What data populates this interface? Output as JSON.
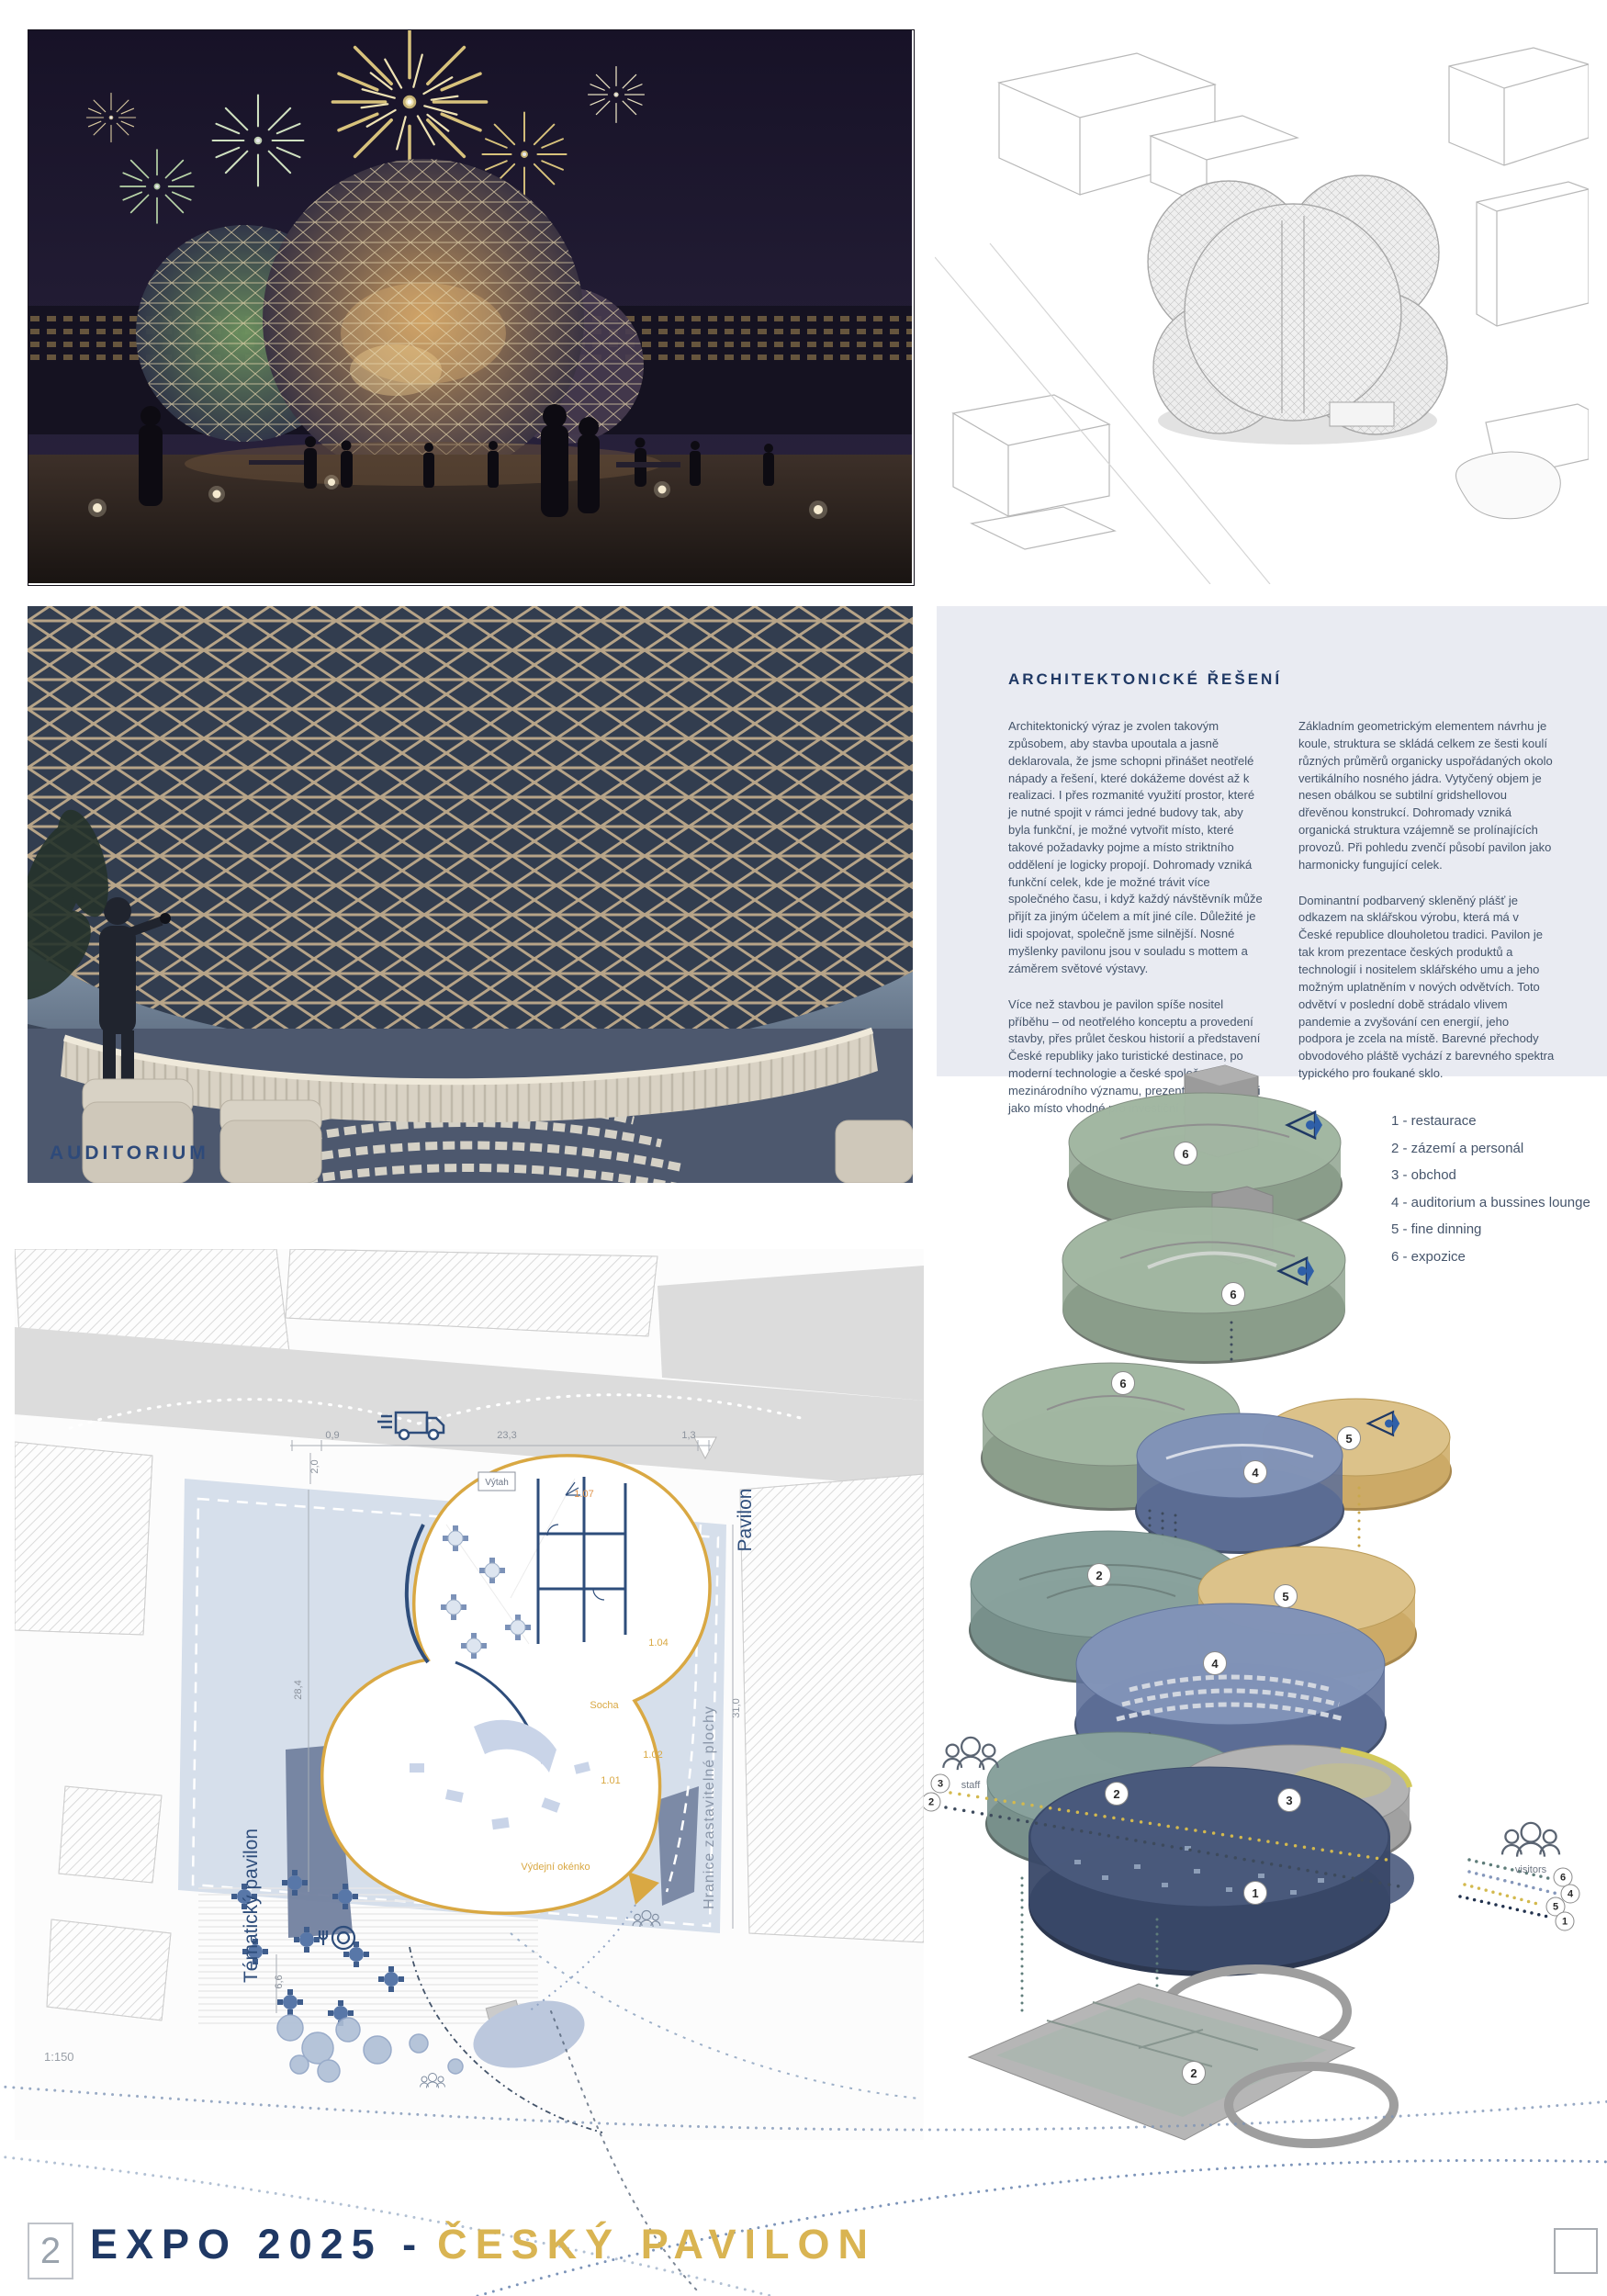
{
  "board": {
    "page_number": "2",
    "title_prefix": "EXPO 2025 -",
    "title_accent": "ČESKÝ PAVILON"
  },
  "auditorium_label": "AUDITORIUM",
  "architecture_section": {
    "heading": "ARCHITEKTONICKÉ ŘEŠENÍ",
    "col1_para1": "Architektonický výraz je zvolen takovým způsobem, aby stavba upoutala a jasně deklarovala, že jsme schopni přinášet neotřelé nápady a řešení, které dokážeme dovést až k realizaci. I přes rozmanité využití prostor, které je nutné spojit v rámci jedné budovy tak, aby byla funkční, je možné vytvořit místo, které takové požadavky pojme a místo striktního oddělení je logicky propojí. Dohromady vzniká funkční celek, kde je možné trávit více společného času, i když každý návštěvník může přijít za jiným účelem a mít jiné cíle. Důležité je lidi spojovat, společně jsme silnější. Nosné myšlenky pavilonu jsou v souladu s mottem a záměrem světové výstavy.",
    "col1_para2": "Více než stavbou je pavilon spíše nositel příběhu – od neotřelého konceptu a provedení stavby, přes průlet českou historií a představení České republiky jako turistické destinace, po moderní technologie a české společnosti mezinárodního významu, prezentující naši zemi jako místo vhodné pro investiční příležitosti.",
    "col2_para1": "Základním geometrickým elementem návrhu je koule, struktura se skládá celkem ze šesti koulí různých průměrů organicky uspořádaných okolo vertikálního nosného jádra. Vytyčený objem je nesen obálkou se subtilní gridshellovou dřevěnou konstrukcí. Dohromady vzniká organická struktura vzájemně se prolínajících provozů. Při pohledu zvenčí působí pavilon jako harmonicky fungující celek.",
    "col2_para2": "Dominantní podbarvený skleněný plášť je odkazem na sklářskou výrobu, která má v České republice dlouholetou tradici. Pavilon je tak krom prezentace českých produktů a technologií i nositelem sklářského umu a jeho možným uplatněním v nových odvětvích. Toto odvětví v poslední době strádalo vlivem pandemie a zvyšování cen energií, jeho podpora je zcela na místě. Barevné přechody obvodového pláště vychází z barevného spektra typického pro foukané sklo."
  },
  "legend": {
    "items": [
      {
        "text": "1 - restaurace"
      },
      {
        "text": "2 - zázemí a personál"
      },
      {
        "text": "3 - obchod"
      },
      {
        "text": "4 - auditorium a bussines lounge"
      },
      {
        "text": "5 - fine dinning"
      },
      {
        "text": "6 - expozice"
      }
    ]
  },
  "exploded": {
    "staff_label": "staff",
    "visitors_label": "visitors",
    "badges": {
      "l1": "6",
      "l2": "6",
      "l3_expo": "6",
      "l3_aud": "4",
      "l3_dine": "5",
      "l4_back": "2",
      "l4_dine": "5",
      "l4_aud": "4",
      "l5_back": "2",
      "l5_shop": "3",
      "l5_rest": "1",
      "l6_base": "2"
    },
    "staff_routes": {
      "r1": "3",
      "r2": "2"
    },
    "visitor_routes": {
      "r1": "6",
      "r2": "4",
      "r3": "5",
      "r4": "1"
    }
  },
  "site_plan": {
    "scale": "1:150",
    "labels": {
      "pavilon": "Pavilon",
      "tematicky_pavilon": "Tématický pavilon",
      "hranice": "Hranice zastavitelné plochy",
      "vytah": "Výtah",
      "socha": "Socha",
      "vydejni_okenko": "Výdejní okénko"
    },
    "rooms": {
      "r101": "1.01",
      "r102": "1.02",
      "r104": "1.04",
      "r107": "1.07"
    },
    "dims": {
      "top_left": "0,9",
      "top_mid": "23,3",
      "top_right": "1,3",
      "left_top": "2,0",
      "left_side": "28,4",
      "bottom_left": "6,6",
      "right_side": "31,0"
    }
  },
  "colors": {
    "navy": "#1F3864",
    "gold": "#D9B452",
    "panel_bg": "#E9EBF2",
    "plan_outline_gold": "#D9A843",
    "level_green": "#9EB49E",
    "level_blue": "#6C7FA6",
    "level_gold": "#D6B878",
    "level_navy": "#3C4C6E",
    "body_text": "#44546A"
  }
}
